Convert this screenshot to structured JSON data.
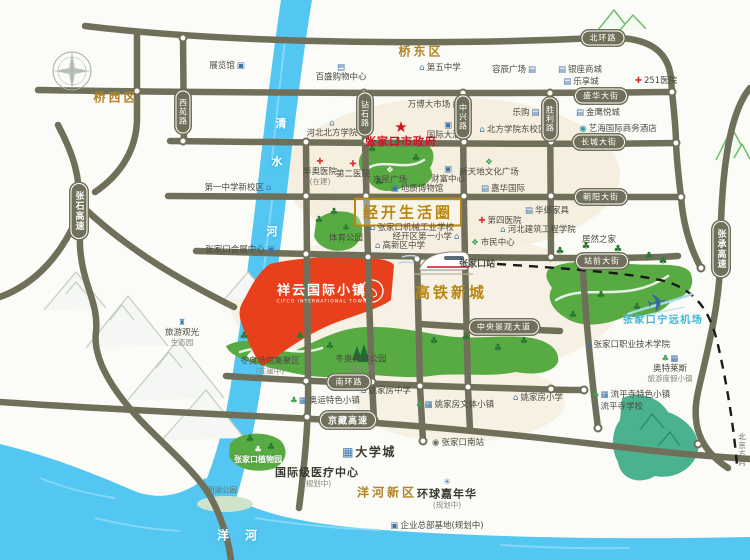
{
  "project": {
    "name": "祥云国际小镇",
    "english": "CIFCO INTERNATIONAL TOWN"
  },
  "regions": [
    {
      "id": "qiaoxi-district",
      "label": "桥西区",
      "x": 116,
      "y": 97
    },
    {
      "id": "qiaodong-district",
      "label": "桥东区",
      "x": 421,
      "y": 51
    },
    {
      "id": "yanghe-new-district",
      "label": "洋河新区",
      "x": 387,
      "y": 492
    },
    {
      "id": "hsr-new-town",
      "label": "高铁新城",
      "x": 451,
      "y": 292,
      "cls": "big"
    },
    {
      "id": "jingkai-life-circle",
      "label": "经开生活圈",
      "x": 408,
      "y": 212,
      "cls": "big boxed"
    }
  ],
  "road_pills": [
    {
      "id": "beihuan-road",
      "label": "北环路",
      "x": 603,
      "y": 38
    },
    {
      "id": "shenghua-street",
      "label": "盛华大街",
      "x": 601,
      "y": 96
    },
    {
      "id": "changcheng-street",
      "label": "长城大街",
      "x": 599,
      "y": 142
    },
    {
      "id": "chaoyang-street",
      "label": "朝阳大街",
      "x": 601,
      "y": 197
    },
    {
      "id": "zhanqian-street",
      "label": "站前大街",
      "x": 602,
      "y": 261
    },
    {
      "id": "nanhuan-road",
      "label": "南环路",
      "x": 349,
      "y": 382
    },
    {
      "id": "central-landscape-avenue",
      "label": "中央景观大道",
      "x": 504,
      "y": 327
    },
    {
      "id": "jingzang-expressway",
      "label": "京藏高速",
      "x": 348,
      "y": 420,
      "hw": true
    },
    {
      "id": "xiyuan-road",
      "label": "西苑路",
      "x": 183,
      "y": 112,
      "v": true
    },
    {
      "id": "zuanshi-road",
      "label": "钻石路",
      "x": 365,
      "y": 114,
      "v": true
    },
    {
      "id": "zhongxing-road",
      "label": "中兴路",
      "x": 463,
      "y": 117,
      "v": true
    },
    {
      "id": "shengli-road",
      "label": "胜利路",
      "x": 550,
      "y": 119,
      "v": true
    },
    {
      "id": "zhangshi-expressway",
      "label": "张石高速",
      "x": 79,
      "y": 211,
      "v": true,
      "hw": true
    },
    {
      "id": "zhangcheng-expressway",
      "label": "张承高速",
      "x": 721,
      "y": 249,
      "v": true,
      "hw": true
    }
  ],
  "pois": [
    {
      "id": "zjk-government",
      "label": "张家口市政府",
      "cx": 401,
      "cy": 134,
      "icon": "★",
      "ic": [
        "redstar"
      ],
      "ipos": "top",
      "cls": "gov"
    },
    {
      "id": "exhibition-hall",
      "label": "展览馆",
      "cx": 227,
      "cy": 66,
      "icon": "▣",
      "ic": [
        "blue"
      ],
      "ipos": "right"
    },
    {
      "id": "parkson-mall",
      "label": "百盛购物中心",
      "cx": 341,
      "cy": 73,
      "icon": "▤",
      "ic": [
        "blue"
      ],
      "ipos": "top"
    },
    {
      "id": "no5-middle-school",
      "label": "第五中学",
      "cx": 440,
      "cy": 68,
      "icon": "⌂",
      "ic": [
        "blue"
      ],
      "ipos": "left"
    },
    {
      "id": "rongchen-plaza",
      "label": "容辰广场",
      "cx": 514,
      "cy": 70,
      "icon": "▤",
      "ic": [
        "blue"
      ],
      "ipos": "right"
    },
    {
      "id": "yinzuo-mall",
      "label": "银座商城",
      "cx": 580,
      "cy": 70,
      "icon": "▤",
      "ic": [
        "blue"
      ],
      "ipos": "left"
    },
    {
      "id": "lexiang-city",
      "label": "乐享城",
      "cx": 581,
      "cy": 82,
      "icon": "▤",
      "ic": [
        "blue"
      ],
      "ipos": "left"
    },
    {
      "id": "hospital-251",
      "label": "251医院",
      "cx": 656,
      "cy": 81,
      "icon": "✚",
      "ic": [
        "red"
      ],
      "ipos": "left"
    },
    {
      "id": "jinying-mall",
      "label": "金鹰悦城",
      "cx": 598,
      "cy": 113,
      "icon": "▤",
      "ic": [
        "blue"
      ],
      "ipos": "left"
    },
    {
      "id": "yihai-hotel",
      "label": "艺海国际商务酒店",
      "cx": 618,
      "cy": 129,
      "icon": "◉",
      "ic": [
        "teal"
      ],
      "ipos": "left"
    },
    {
      "id": "tesco",
      "label": "乐购",
      "cx": 526,
      "cy": 113,
      "icon": "▤",
      "ic": [
        "blue"
      ],
      "ipos": "right"
    },
    {
      "id": "wanbo-market",
      "label": "万博大市场",
      "cx": 434,
      "cy": 105,
      "icon": "▤",
      "ic": [
        "blue"
      ],
      "ipos": "right"
    },
    {
      "id": "hebei-north-college",
      "label": "河北北方学院",
      "cx": 332,
      "cy": 129,
      "icon": "⌂",
      "ic": [
        "blue"
      ],
      "ipos": "top"
    },
    {
      "id": "intl-hotel",
      "label": "国际大酒店",
      "cx": 448,
      "cy": 131,
      "icon": "▣",
      "ic": [
        "blue"
      ],
      "ipos": "top"
    },
    {
      "id": "north-college-east-campus",
      "label": "北方学院东校区",
      "cx": 513,
      "cy": 130,
      "icon": "⌂",
      "ic": [
        "blue"
      ],
      "ipos": "left"
    },
    {
      "id": "xintiandi-culture-plaza",
      "label": "新天地文化广场",
      "cx": 489,
      "cy": 168,
      "icon": "❖",
      "ic": [
        "green"
      ],
      "ipos": "top"
    },
    {
      "id": "jiahua-international",
      "label": "嘉华国际",
      "cx": 503,
      "cy": 189,
      "icon": "▤",
      "ic": [
        "blue"
      ],
      "ipos": "left"
    },
    {
      "id": "huaao-hospital",
      "label": "华奥医院",
      "sub": "(在建)",
      "cx": 320,
      "cy": 172,
      "icon": "✚",
      "ic": [
        "red"
      ],
      "ipos": "top"
    },
    {
      "id": "no2-hospital",
      "label": "第二医院",
      "cx": 353,
      "cy": 170,
      "icon": "✚",
      "ic": [
        "red"
      ],
      "ipos": "top"
    },
    {
      "id": "citizen-square",
      "label": "市民广场",
      "cx": 390,
      "cy": 176,
      "icon": "❖",
      "ic": [
        "white"
      ],
      "ipos": "top"
    },
    {
      "id": "wealth-center",
      "label": "财富中心",
      "cx": 448,
      "cy": 175,
      "icon": "▣",
      "ic": [
        "blue"
      ],
      "ipos": "top"
    },
    {
      "id": "geology-museum",
      "label": "地质博物馆",
      "cx": 417,
      "cy": 189,
      "icon": "▣",
      "ic": [
        "blue"
      ],
      "ipos": "left"
    },
    {
      "id": "sports-park",
      "label": "体育公园",
      "cx": 346,
      "cy": 234,
      "icon": "♣",
      "ic": [
        "dkgreen"
      ],
      "ipos": "top"
    },
    {
      "id": "machinery-industry-school",
      "label": "张家口机械工业学校",
      "cx": 412,
      "cy": 228,
      "icon": "⌂",
      "ic": [
        "blue"
      ],
      "ipos": "left"
    },
    {
      "id": "jingkai-no1-primary",
      "label": "经开区第一小学",
      "cx": 426,
      "cy": 237,
      "icon": "⌂",
      "ic": [
        "blue"
      ],
      "ipos": "right"
    },
    {
      "id": "gaoxin-middle-school",
      "label": "高新区中学",
      "cx": 400,
      "cy": 246,
      "icon": "⌂",
      "ic": [
        "blue"
      ],
      "ipos": "left"
    },
    {
      "id": "no4-hospital",
      "label": "第四医院",
      "cx": 500,
      "cy": 221,
      "icon": "✚",
      "ic": [
        "red"
      ],
      "ipos": "left"
    },
    {
      "id": "hebei-architecture-college",
      "label": "河北建筑工程学院",
      "cx": 538,
      "cy": 230,
      "icon": "⌂",
      "ic": [
        "blue"
      ],
      "ipos": "left"
    },
    {
      "id": "citizen-center",
      "label": "市民中心",
      "cx": 493,
      "cy": 243,
      "icon": "❖",
      "ic": [
        "green"
      ],
      "ipos": "left"
    },
    {
      "id": "zjk-railway-station",
      "label": "张家口站",
      "cx": 477,
      "cy": 265,
      "cls": "station"
    },
    {
      "id": "huaye-furniture",
      "label": "华邺家具",
      "cx": 547,
      "cy": 211,
      "icon": "▤",
      "ic": [
        "blue"
      ],
      "ipos": "left"
    },
    {
      "id": "juran-home",
      "label": "居然之家",
      "cx": 599,
      "cy": 240
    },
    {
      "id": "winter-olympic-venues",
      "label": "冬奥场馆集聚区",
      "sub": "(在建中)",
      "cx": 270,
      "cy": 366
    },
    {
      "id": "winter-olympic-forest-park",
      "label": "冬奥森林公园",
      "sub": "(在建中)",
      "cx": 361,
      "cy": 364
    },
    {
      "id": "yaojiafang-middle-school",
      "label": "姚家房中学",
      "cx": 386,
      "cy": 391,
      "icon": "⌂",
      "ic": [
        "blue"
      ],
      "ipos": "left"
    },
    {
      "id": "yaojiafang-culture-town",
      "label": "姚家房文体小镇",
      "cx": 455,
      "cy": 405,
      "icon": "♣▦",
      "ic": [
        "green",
        "blue"
      ],
      "ipos": "left"
    },
    {
      "id": "yaojiafang-primary",
      "label": "姚家房小学",
      "cx": 538,
      "cy": 398,
      "icon": "⌂",
      "ic": [
        "blue"
      ],
      "ipos": "left"
    },
    {
      "id": "olympic-town",
      "label": "奥运特色小镇",
      "cx": 325,
      "cy": 401,
      "icon": "♣▦",
      "ic": [
        "green",
        "blue"
      ],
      "ipos": "left"
    },
    {
      "id": "outlets-resort-town",
      "label": "奥特莱斯",
      "sub": "旅游度假小镇",
      "cx": 670,
      "cy": 369,
      "icon": "♣▦",
      "ic": [
        "green",
        "blue"
      ],
      "ipos": "top"
    },
    {
      "id": "liupingsi-town",
      "label": "流平寺特色小镇",
      "cx": 631,
      "cy": 395,
      "icon": "♣▦",
      "ic": [
        "green",
        "blue"
      ],
      "ipos": "left"
    },
    {
      "id": "liupingsi-school",
      "label": "流平寺学校",
      "cx": 618,
      "cy": 407,
      "icon": "⌂",
      "ic": [
        "blue"
      ],
      "ipos": "left"
    },
    {
      "id": "zjk-vocational-college",
      "label": "张家口职业技术学院",
      "cx": 628,
      "cy": 345,
      "icon": "⌂",
      "ic": [
        "blue"
      ],
      "ipos": "left"
    },
    {
      "id": "ningyuan-airport",
      "label": "张家口宁远机场",
      "cx": 663,
      "cy": 321,
      "cls": "air"
    },
    {
      "id": "zjk-botanical-garden",
      "label": "张家口植物园",
      "cx": 258,
      "cy": 455,
      "icon": "♣",
      "ic": [
        "white"
      ],
      "ipos": "top",
      "cls": "white"
    },
    {
      "id": "minghu-park",
      "label": "明湖公园",
      "cx": 222,
      "cy": 490,
      "cls": "tiny"
    },
    {
      "id": "intl-medical-center",
      "label": "国际级医疗中心",
      "sub": "(规划中)",
      "cx": 317,
      "cy": 477,
      "cls": "med"
    },
    {
      "id": "university-city",
      "label": "大学城",
      "cx": 369,
      "cy": 452,
      "icon": "▦",
      "ic": [
        "bigblue"
      ],
      "ipos": "left",
      "cls": "big"
    },
    {
      "id": "zjk-south-station",
      "label": "张家口南站",
      "cx": 458,
      "cy": 443,
      "icon": "◉",
      "ic": [
        "olive"
      ],
      "ipos": "left"
    },
    {
      "id": "global-carnival",
      "label": "环球嘉年华",
      "sub": "(规划中)",
      "cx": 447,
      "cy": 494,
      "icon": "✳",
      "ic": [
        "blue"
      ],
      "ipos": "top",
      "cls": "med"
    },
    {
      "id": "enterprise-hq-base",
      "label": "企业总部基地(规划中)",
      "cx": 437,
      "cy": 526,
      "icon": "▣",
      "ic": [
        "blue"
      ],
      "ipos": "left"
    },
    {
      "id": "tourism-eco-garden",
      "label": "旅游观光",
      "sub": "生态园",
      "cx": 182,
      "cy": 333,
      "icon": "♜",
      "ic": [
        "blue"
      ],
      "ipos": "top"
    },
    {
      "id": "no1-middle-school-new-campus",
      "label": "第一中学新校区",
      "cx": 238,
      "cy": 188,
      "icon": "⌂",
      "ic": [
        "blue"
      ],
      "ipos": "right"
    },
    {
      "id": "zjk-convention-center",
      "label": "张家口会展中心",
      "cx": 240,
      "cy": 250,
      "icon": "▣",
      "ic": [
        "blue"
      ],
      "ipos": "right"
    },
    {
      "id": "beijing-direction",
      "label": "北京方向",
      "cx": 742,
      "cy": 450,
      "cls": "tiny vert"
    }
  ],
  "river_labels": [
    {
      "ch": "清",
      "x": 281,
      "y": 123
    },
    {
      "ch": "水",
      "x": 277,
      "y": 161
    },
    {
      "ch": "河",
      "x": 272,
      "y": 231
    },
    {
      "ch": "洋",
      "x": 224,
      "y": 535,
      "big": true
    },
    {
      "ch": "河",
      "x": 252,
      "y": 535,
      "big": true
    }
  ],
  "trees": [
    [
      372,
      150
    ],
    [
      398,
      142
    ],
    [
      416,
      159
    ],
    [
      379,
      183
    ],
    [
      319,
      221
    ],
    [
      334,
      213
    ],
    [
      560,
      252
    ],
    [
      586,
      247
    ],
    [
      618,
      250
    ],
    [
      649,
      257
    ],
    [
      601,
      296
    ],
    [
      637,
      308
    ],
    [
      573,
      316
    ],
    [
      663,
      262
    ],
    [
      244,
      337
    ],
    [
      300,
      337
    ],
    [
      330,
      347
    ],
    [
      434,
      342
    ],
    [
      466,
      338
    ],
    [
      498,
      349
    ],
    [
      524,
      342
    ],
    [
      250,
      440
    ],
    [
      271,
      448
    ]
  ],
  "misc": {
    "tree_glyph": "♣",
    "plane_glyph": "✈"
  },
  "colors": {
    "road": "#70705a",
    "river": "#53c6f1",
    "green": "#58ab43",
    "teal_hill": "#4bb290",
    "project_red": "#e8401c",
    "gold": "#b8860e",
    "gov_red": "#cf1220",
    "airport_blue": "#3eb5da",
    "cream_zone": "#f6efe0",
    "dashed_line": "#1a1a1a"
  }
}
